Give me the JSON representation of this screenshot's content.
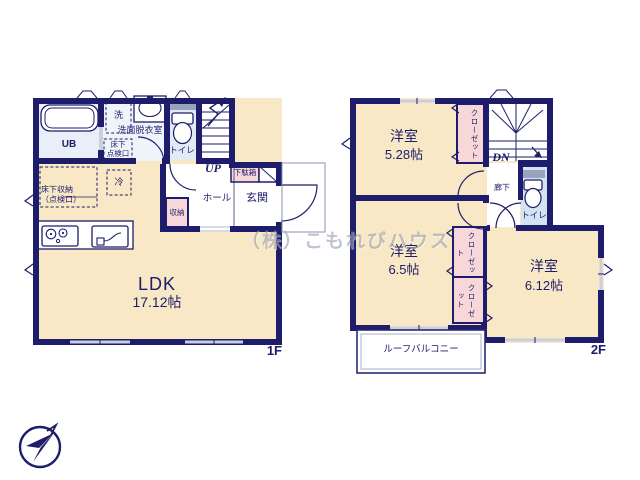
{
  "watermark": "（株）こもれびハウス",
  "colors": {
    "wall": "#1d1d6b",
    "ink": "#1d1d6b",
    "floor": "#f8e8c5",
    "pink": "#f8d7d8",
    "bath": "#e9eff9",
    "washroom": "#eff4fb",
    "toilet1": "#e2eaf6",
    "toilet2": "#d5e2f2",
    "gray": "#98a3bd",
    "window": "#c9cfdc",
    "watermark": "#9ba1b3"
  },
  "floor1": {
    "label": "1F",
    "ldk": {
      "name": "LDK",
      "size": "17.12帖"
    },
    "ub": "UB",
    "washroom": "洗面脱衣室",
    "washer": "洗",
    "hatch": [
      "床下",
      "点検口"
    ],
    "toilet": "トイレ",
    "up": "UP",
    "hall": "ホール",
    "entrance": "玄関",
    "shoe_cabinet": "下駄箱",
    "storage": "収納",
    "fridge": "冷",
    "underfloor_storage": [
      "床下収納",
      "（点検口）"
    ]
  },
  "floor2": {
    "label": "2F",
    "dn": "DN",
    "corridor": "廊下",
    "toilet": "トイレ",
    "closet": "クローゼット",
    "rooms": [
      {
        "name": "洋室",
        "size": "5.28帖"
      },
      {
        "name": "洋室",
        "size": "6.5帖"
      },
      {
        "name": "洋室",
        "size": "6.12帖"
      }
    ],
    "balcony": "ルーフバルコニー"
  }
}
